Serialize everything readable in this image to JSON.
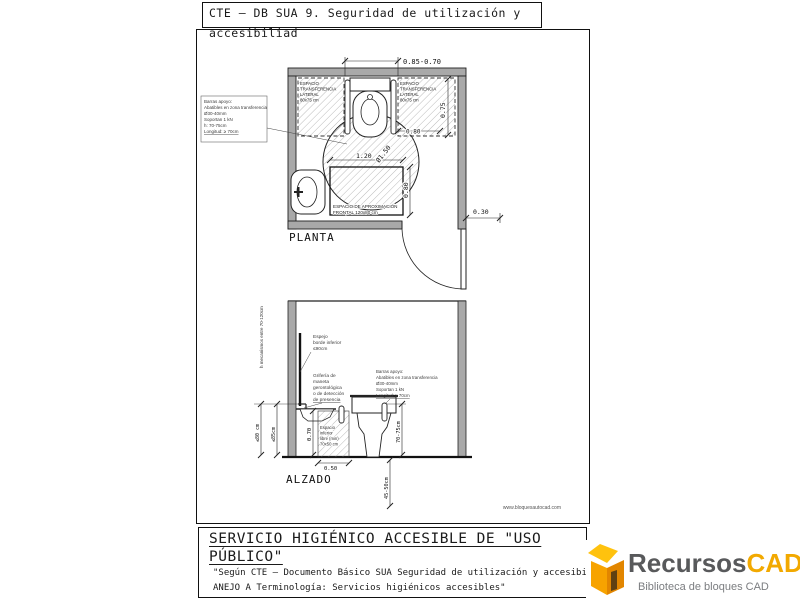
{
  "header": {
    "title_line1": "CTE — DB SUA 9. Seguridad de utilización y",
    "title_line2": "accesibiliad"
  },
  "plan": {
    "view_label": "PLANTA",
    "note_box": [
      "Barras apoyo:",
      "Abatibles en zona transferencia",
      "Ø30-40mm",
      "Soportan 1 kN",
      "h: 70-75cm",
      "Longitud: ≥ 70cm"
    ],
    "transfer_space_left": [
      "ESPACIO",
      "TRANSFERENCIA",
      "LATERAL",
      "80x75 cm"
    ],
    "transfer_space_right": [
      "ESPACIO",
      "TRANSFERENCIA",
      "LATERAL",
      "80x75 cm"
    ],
    "approach_space": [
      "ESPACIO DE APROXIMACIÓN",
      "FRONTAL 120x80 cm"
    ],
    "dim_door_width": "0.85-0.70",
    "dim_depth": "0.75",
    "dim_transfer_width": "0.80",
    "dim_approach_width": "1.20",
    "dim_approach_depth": "0.80",
    "dim_turning_circle": "Ø1.50",
    "dim_door_offset": "0.30"
  },
  "elevation": {
    "view_label": "ALZADO",
    "mirror_note": [
      "Espejo",
      "borde inferior",
      "≤90cm"
    ],
    "tap_note": [
      "Grifería de",
      "maneta",
      "gerontológica",
      "o de detección",
      "de presencia"
    ],
    "bars_note": [
      "Barras apoyo:",
      "Abatibles en zona transferencia",
      "Ø30-40mm",
      "Soportan 1 kN",
      "Longitud: ≥ 70cm"
    ],
    "mechanisms_note": "h mecanismos entre 70-120cm",
    "free_space_label": [
      "Espacio",
      "inferior",
      "libre (min)",
      "70x50 cm"
    ],
    "dim_basin_free": "≤80 cm",
    "dim_basin_top": "≤85cm",
    "dim_free_height": "0.70",
    "dim_free_depth": "0.50",
    "dim_bar_height": "70-75cm",
    "dim_seat_height": "45-50cm"
  },
  "watermark": "www.bloquesautocad.com",
  "footer": {
    "heading_line1": "SERVICIO HIGIÉNICO ACCESIBLE DE \"USO",
    "heading_line2": "PÚBLICO\"",
    "body_line1": "\"Según CTE — Documento Básico SUA Seguridad de utilización y accesibilid",
    "body_line2": "ANEJO A Terminología: Servicios higiénicos accesibles\""
  },
  "logo": {
    "brand_primary": "Recursos",
    "brand_secondary": "CAD",
    "tagline": "Biblioteca de bloques CAD",
    "colors": {
      "primary_text": "#58595b",
      "secondary_text": "#f2a900",
      "icon_orange": "#f28c00",
      "icon_yellow": "#ffc20e"
    }
  }
}
